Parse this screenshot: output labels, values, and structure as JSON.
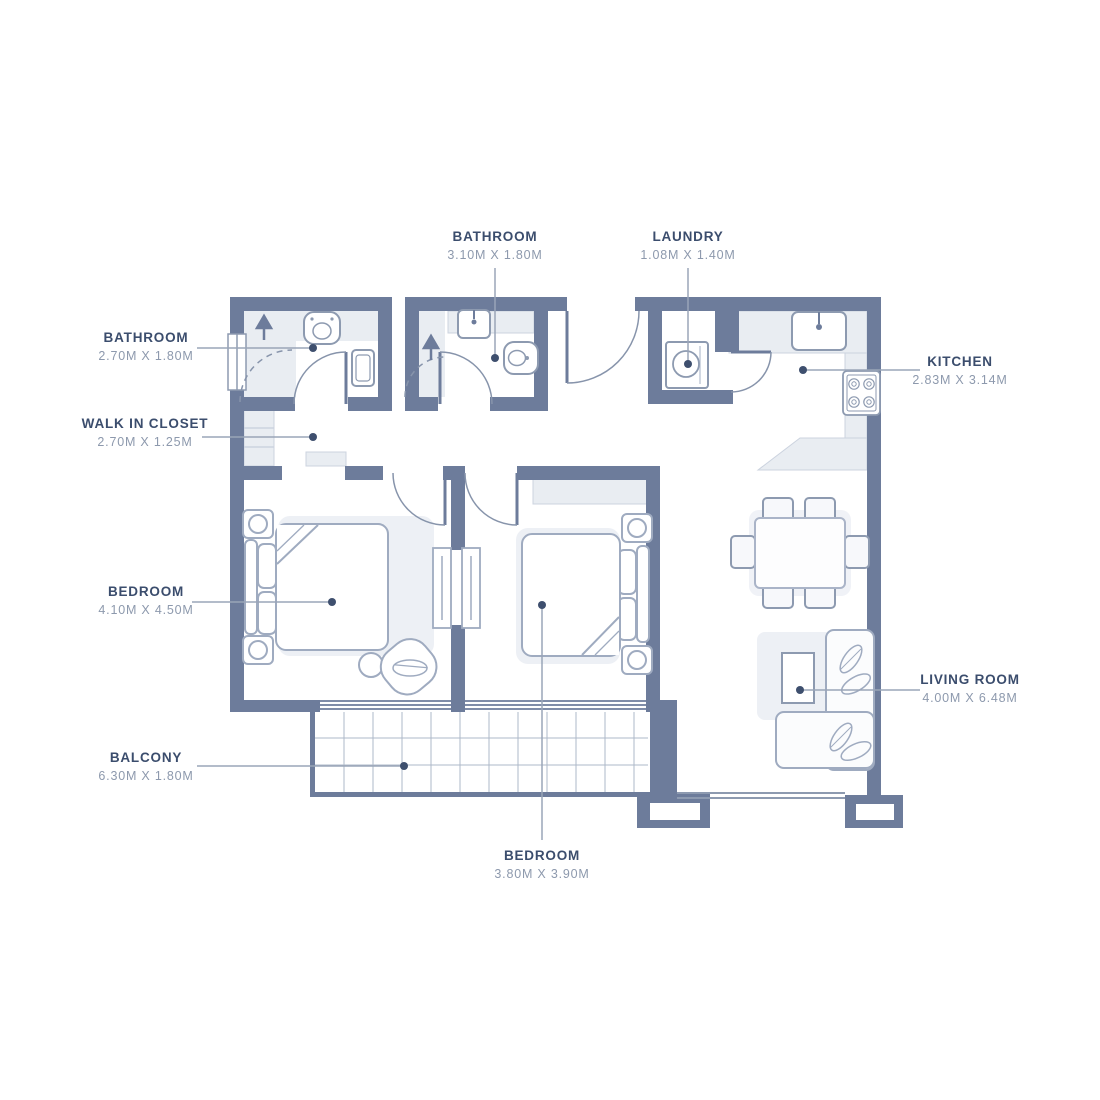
{
  "floor_plan": {
    "rooms": [
      {
        "id": "bathroom-top",
        "name": "BATHROOM",
        "dimensions": "3.10M X 1.80M"
      },
      {
        "id": "laundry",
        "name": "LAUNDRY",
        "dimensions": "1.08M X 1.40M"
      },
      {
        "id": "bathroom-left",
        "name": "BATHROOM",
        "dimensions": "2.70M X 1.80M"
      },
      {
        "id": "kitchen",
        "name": "KITCHEN",
        "dimensions": "2.83M X 3.14M"
      },
      {
        "id": "walk-in-closet",
        "name": "WALK IN CLOSET",
        "dimensions": "2.70M X 1.25M"
      },
      {
        "id": "bedroom-1",
        "name": "BEDROOM",
        "dimensions": "4.10M X 4.50M"
      },
      {
        "id": "living-room",
        "name": "LIVING ROOM",
        "dimensions": "4.00M X 6.48M"
      },
      {
        "id": "balcony",
        "name": "BALCONY",
        "dimensions": "6.30M X 1.80M"
      },
      {
        "id": "bedroom-2",
        "name": "BEDROOM",
        "dimensions": "3.80M X 3.90M"
      }
    ],
    "fixtures": [
      "shower-icon",
      "toilet-icon",
      "sink-icon",
      "washing-machine-icon",
      "stove-icon",
      "bed",
      "nightstand",
      "wardrobe",
      "armchair",
      "side-table",
      "dining-table",
      "dining-chair",
      "sofa",
      "coffee-table",
      "balcony-tiles",
      "door-arc",
      "window"
    ],
    "colors": {
      "wall": "#6d7c9b",
      "floor_light": "#e9edf2",
      "furniture_outline": "#9fabc0",
      "label_text": "#3b4d6d",
      "dimension_text": "#8d99ad",
      "leader_line": "#9aa5b8",
      "leader_dot": "#3e4f6e"
    }
  }
}
